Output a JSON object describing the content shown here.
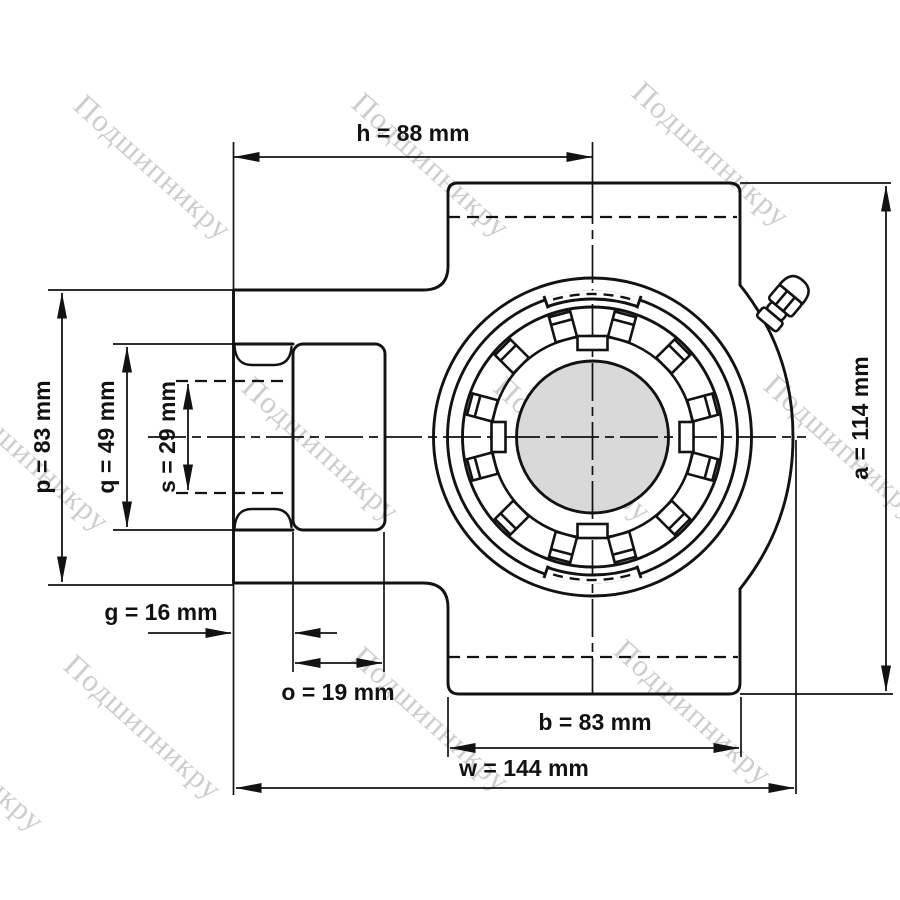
{
  "drawing": {
    "kind": "bearing-unit-technical-drawing",
    "units": "mm"
  },
  "dimensions": {
    "h": "h = 88 mm",
    "a": "a = 114 mm",
    "p": "p = 83 mm",
    "q": "q = 49 mm",
    "s": "s = 29 mm",
    "g": "g = 16 mm",
    "o": "o = 19 mm",
    "b": "b = 83 mm",
    "w": "w = 144 mm"
  },
  "watermark": {
    "text": "Подшипникру",
    "color": "#c5c5c5"
  },
  "colors": {
    "line": "#121212",
    "shaft_fill": "#d9d9d9",
    "background": "#ffffff"
  }
}
